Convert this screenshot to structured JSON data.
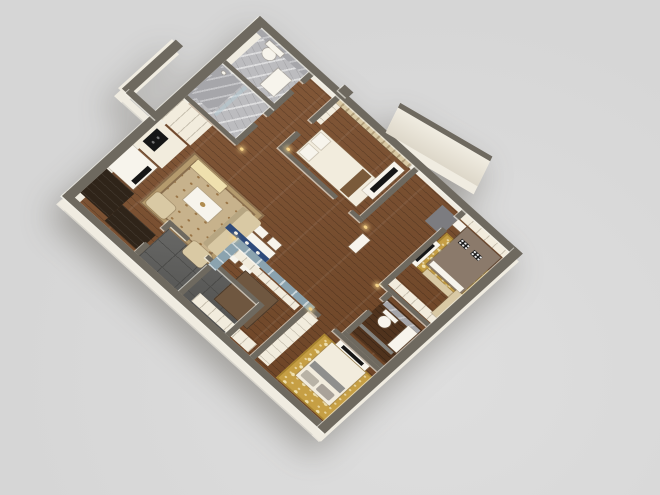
{
  "scene": {
    "description": "3D isometric top-down render of a three-bedroom apartment floor plan, rotated 45 degrees on a plain light gray background",
    "view": "axonometric cutaway, walls shown as gray caps with cream interior faces",
    "no_visible_text": true
  },
  "colors": {
    "bg": "#d6d6d6",
    "bg-lt": "#dedede",
    "wall": "#6e695f",
    "face": "#f0ece1",
    "wood": "#7a4c2a",
    "wood-dk": "#50331d",
    "marble": "#bcbcbf",
    "marble-dk": "#a6a6aa",
    "slate": "#5e5e5c",
    "slate-line": "#4b4b49",
    "blue": "#8ba3af",
    "cream": "#f2ecdd",
    "white": "#f7f4ec",
    "beige": "#d9c9a4",
    "taupe": "#8b7a6b",
    "rug": "#c7b28c",
    "rug-bd": "#8a6f4e",
    "gold": "#c69f44",
    "gold-lt": "#efe0ae",
    "dark": "#2f2419",
    "tv": "#161616",
    "navy": "#2e4a7a",
    "gray-throw": "#8f8f8d",
    "warm": "#f6d489"
  },
  "rooms": [
    {
      "id": "bathroom-1",
      "name": "Bathroom 1 (guest WC)",
      "floor": "gray marble",
      "furniture": [
        "toilet",
        "vanity sink"
      ]
    },
    {
      "id": "bathroom-2",
      "name": "Bathroom 2 (shower room)",
      "floor": "gray marble",
      "furniture": [
        "walk-in shower",
        "glass screen"
      ]
    },
    {
      "id": "hallway",
      "name": "Hallway with closets",
      "floor": "wood",
      "furniture": [
        "built-in wardrobes",
        "console table"
      ]
    },
    {
      "id": "bedroom-2",
      "name": "Bedroom 2",
      "floor": "wood",
      "furniture": [
        "double bed",
        "TV console",
        "curtains",
        "wardrobe"
      ]
    },
    {
      "id": "entry",
      "name": "Entry vestibule",
      "floor": "wood with dark stone pad",
      "furniture": [
        "angled entrance wall"
      ]
    },
    {
      "id": "kitchen",
      "name": "Kitchen",
      "floor": "wood",
      "furniture": [
        "white counter with cooktop",
        "dark tall cabinets"
      ]
    },
    {
      "id": "living-room",
      "name": "Living room",
      "floor": "wood",
      "furniture": [
        "TV wall unit",
        "sofa",
        "coffee table",
        "patterned rug",
        "settee",
        "armchairs"
      ]
    },
    {
      "id": "dining-area",
      "name": "Dining nook with blue wainscot",
      "floor": "wood",
      "furniture": [
        "dining table",
        "blue table runner",
        "six chairs"
      ]
    },
    {
      "id": "middle-bedroom",
      "name": "Middle bedroom / study",
      "floor": "wood",
      "furniture": [
        "bed with brown cover",
        "built-in closet"
      ]
    },
    {
      "id": "master-bedroom",
      "name": "Master bedroom",
      "floor": "wood",
      "furniture": [
        "double bed",
        "black-and-white accent pillows",
        "gold rug",
        "nightstand",
        "wardrobe",
        "TV console",
        "curtains"
      ]
    },
    {
      "id": "ensuite-bathroom",
      "name": "Ensuite bathroom",
      "floor": "dark wood tile",
      "furniture": [
        "toilet",
        "vanity",
        "shower screen"
      ]
    },
    {
      "id": "bedroom-3",
      "name": "Bedroom 3",
      "floor": "wood",
      "furniture": [
        "double bed",
        "gray throw",
        "gold patterned rug",
        "closet",
        "TV console"
      ]
    },
    {
      "id": "balcony",
      "name": "Balcony",
      "floor": "dark slate tile",
      "furniture": [
        "window wall opening"
      ]
    }
  ]
}
